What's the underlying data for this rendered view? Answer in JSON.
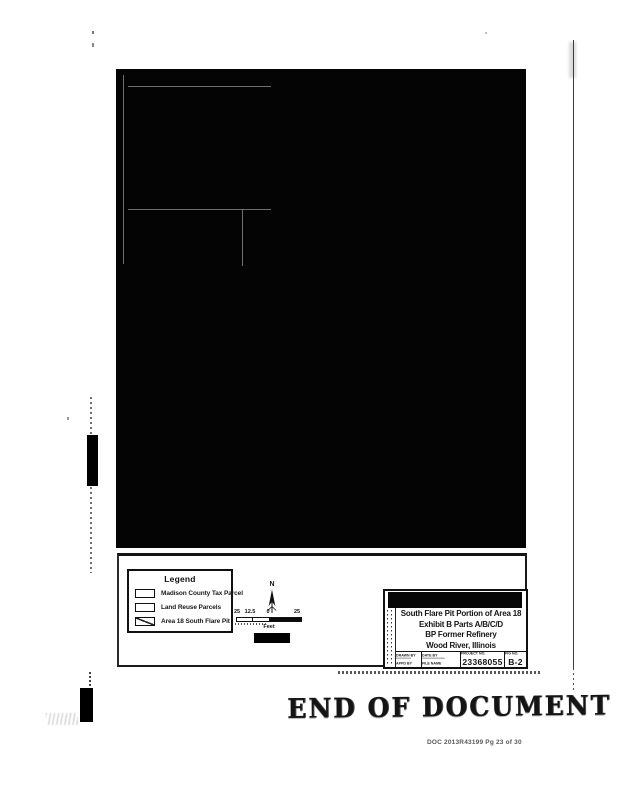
{
  "page": {
    "background_color": "#ffffff",
    "ink_color": "#111111"
  },
  "legend": {
    "title": "Legend",
    "items": [
      {
        "label": "Madison County Tax Parcel",
        "swatch": "outline"
      },
      {
        "label": "Land Reuse Parcels",
        "swatch": "outline"
      },
      {
        "label": "Area 18 South Flare Pit",
        "swatch": "diagonal-hatch"
      }
    ]
  },
  "north_arrow": {
    "label": "N"
  },
  "scale_bar": {
    "ticks": [
      "25",
      "12.5",
      "0",
      "25"
    ],
    "unit": "Feet"
  },
  "title_block": {
    "title_lines": [
      "South Flare Pit Portion of Area 18",
      "Exhibit B Parts A/B/C/D",
      "BP Former Refinery",
      "Wood River, Illinois"
    ],
    "small_fields": [
      {
        "row1": "DRAWN BY",
        "row2": "APPD BY"
      },
      {
        "row1": "DATE BY",
        "row2": "FILE NAME"
      }
    ],
    "project_label": "PROJECT NO.",
    "project_number": "23368055",
    "figure_label": "FIG NO.",
    "figure_number": "B-2"
  },
  "stamp": {
    "text": "END OF DOCUMENT"
  },
  "footer": {
    "doc_reference": "DOC 2013R43199 Pg 23 of 30"
  }
}
